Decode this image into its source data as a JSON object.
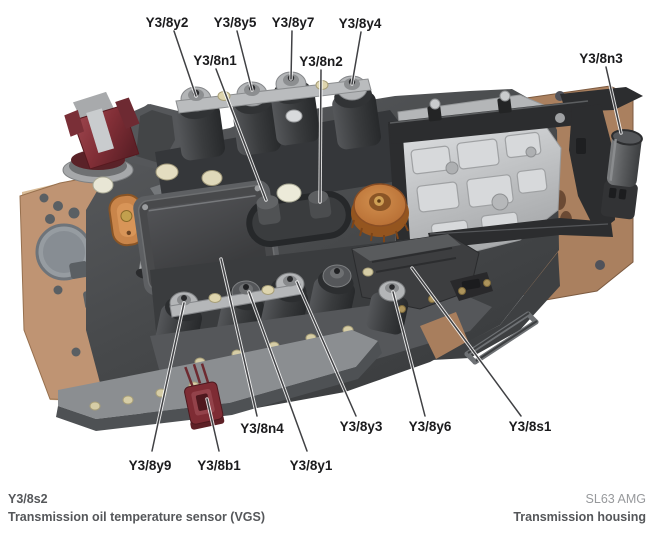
{
  "figure": {
    "callouts": {
      "y2": "Y3/8y2",
      "y5": "Y3/8y5",
      "y7": "Y3/8y7",
      "y4": "Y3/8y4",
      "n1": "Y3/8n1",
      "n2": "Y3/8n2",
      "n3": "Y3/8n3",
      "y9": "Y3/8y9",
      "b1": "Y3/8b1",
      "n4": "Y3/8n4",
      "y1": "Y3/8y1",
      "y3": "Y3/8y3",
      "y6": "Y3/8y6",
      "s1": "Y3/8s1"
    }
  },
  "caption": {
    "part_code": "Y3/8s2",
    "part_name": "Transmission oil temperature sensor (VGS)",
    "vehicle": "SL63 AMG",
    "location": "Transmission housing"
  },
  "colors": {
    "background": "#ffffff",
    "separator_plate": "#bf9473",
    "separator_plate_right": "#aa805f",
    "housing": "#4b4d4f",
    "housing_light": "#74777a",
    "control_module": "#48494b",
    "aluminum_block": "#c7c9cb",
    "frame_black": "#2c2d2f",
    "solenoid_cap": "#b3b5b7",
    "maroon_connector": "#8c3a42",
    "red_connector": "#7e2c34",
    "orange_sensor": "#c9854a",
    "orange_knob": "#c0763a",
    "sensor_n3": "#5c5e60",
    "leader_line": "#404144",
    "label_text": "#1b1b1d",
    "caption_text": "#55575a",
    "caption_muted": "#97999c"
  }
}
